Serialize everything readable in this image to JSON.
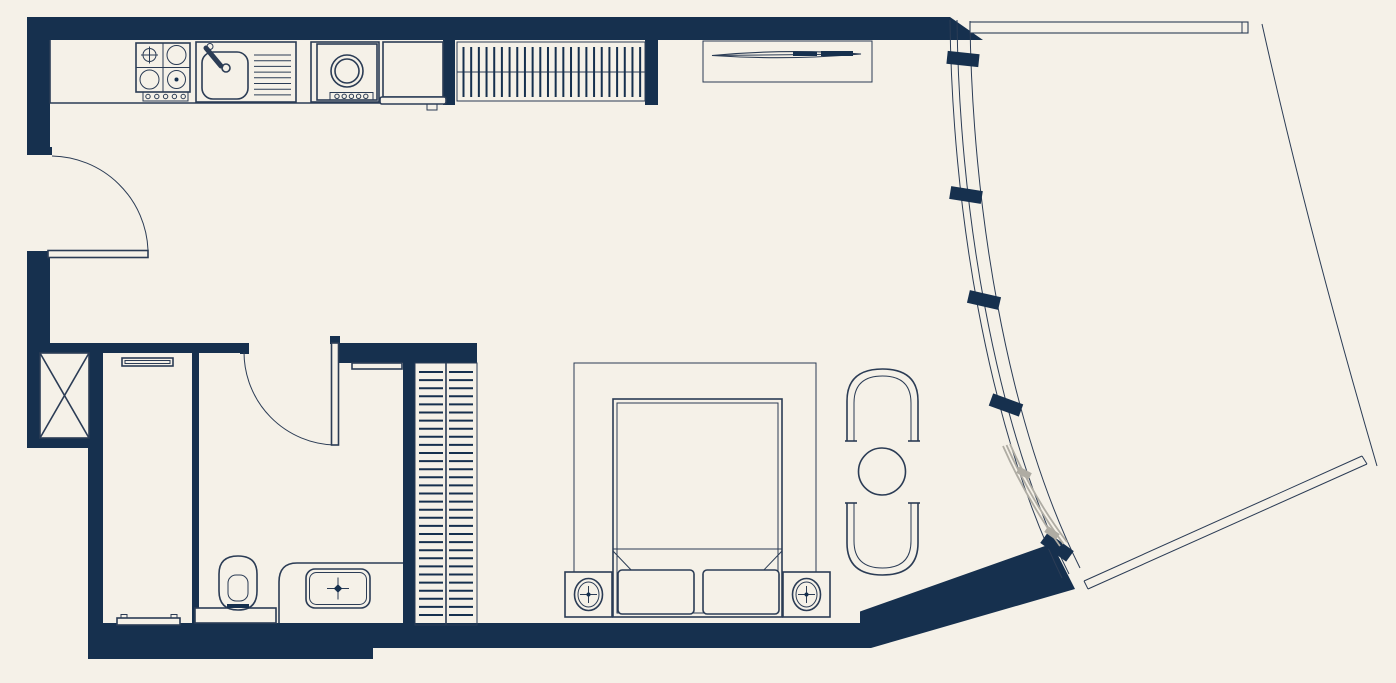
{
  "meta": {
    "type": "architectural-floor-plan",
    "description": "Studio apartment floor plan with linear kitchen, bathroom, wardrobe, bedroom / lounge zone and a curved glazed facade opening onto a large wedge-shaped balcony",
    "text_labels": []
  },
  "colors": {
    "background": "#F5F1E8",
    "wall": "#16304E",
    "line": "#2B3C55",
    "gray": "#AFACA3"
  },
  "legend": {
    "kitchen": [
      "hob-4-burner",
      "kitchen-sink-with-drainer",
      "washing-machine",
      "refrigerator",
      "coat-closet-with-hangers"
    ],
    "living_sleeping": [
      "tv-console",
      "tv-screen",
      "bed-rug",
      "double-bed",
      "pillows",
      "nightstand-with-lamp-left",
      "nightstand-with-lamp-right",
      "armchair-top",
      "armchair-bottom",
      "round-coffee-table"
    ],
    "bathroom": [
      "wall-hung-toilet",
      "vanity-counter",
      "wash-basin",
      "mirror-shelf"
    ],
    "service": [
      "utility-shaft",
      "entry-hall-shelf",
      "entry-hall-mat",
      "double-sided-wardrobe"
    ],
    "doors": [
      "entrance-door-swing",
      "bathroom-door-swing",
      "gray-sliding-balcony-door"
    ],
    "facade": [
      "curved-curtain-wall",
      "facade-fin-blocks",
      "balcony-top-railing",
      "balcony-bottom-railing",
      "balcony-edge-line"
    ]
  }
}
